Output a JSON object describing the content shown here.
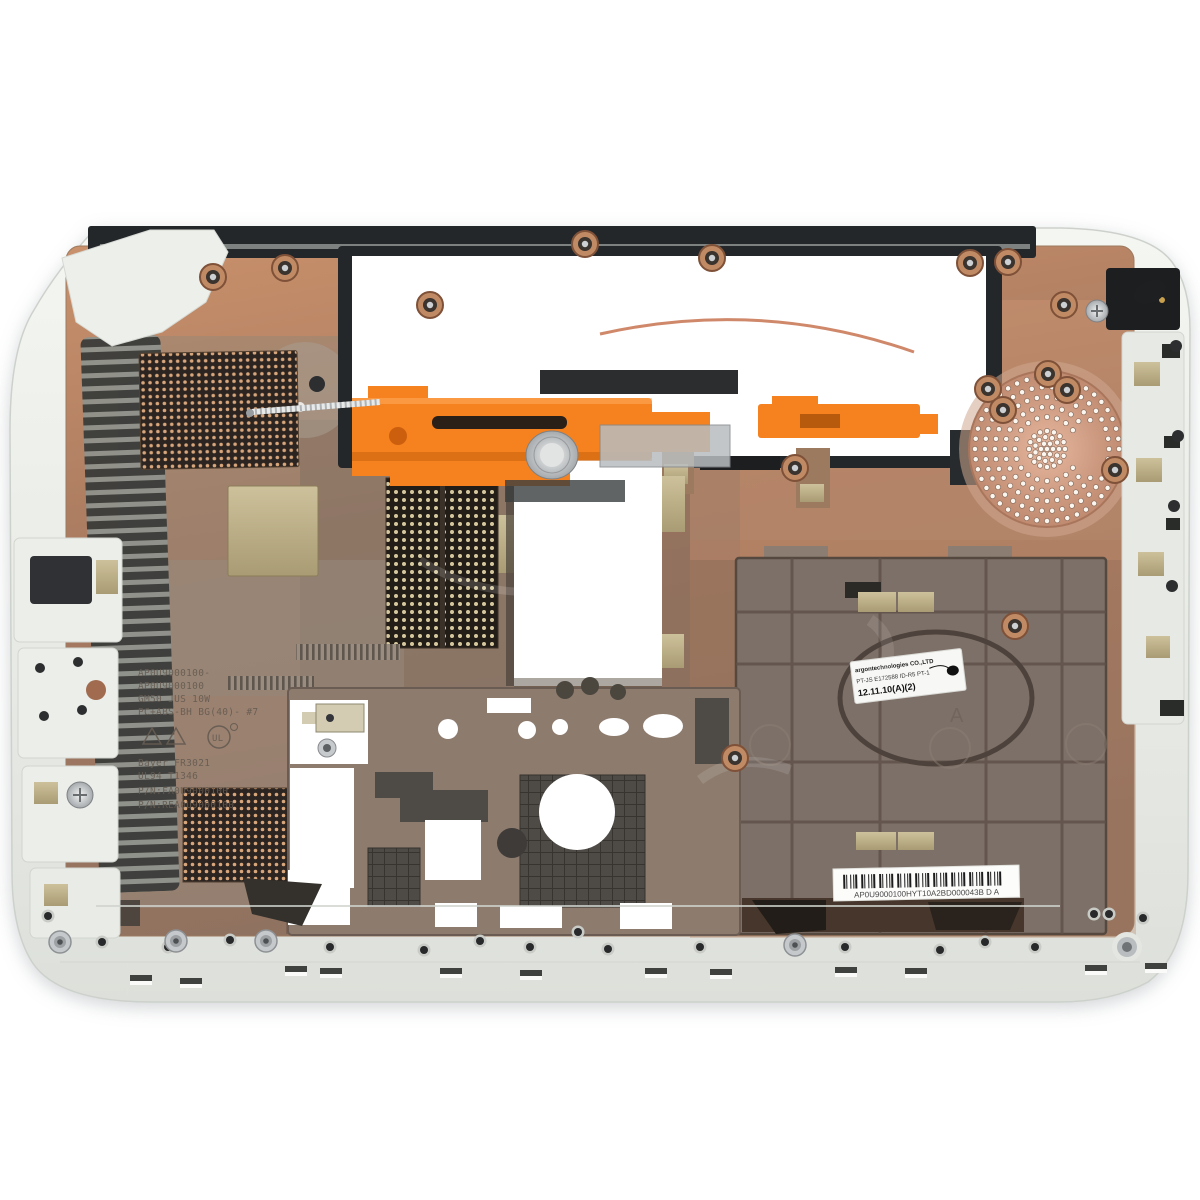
{
  "meta": {
    "title": "Laptop bottom base enclosure — interior view product photo",
    "description": "White plastic laptop bottom case photographed from inside: copper EMI-coated interior, black battery-bay frame, orange optical-drive eject bracket with spring, perforated vent meshes, round speaker grille, molded part numbers, service label and barcode label."
  },
  "palette": {
    "background": "#ffffff",
    "rim": "#e9ebe7",
    "copper": "#c08262",
    "copper_dark": "#8f6f5d",
    "panel_gray": "#7d7068",
    "black_plastic": "#24272a",
    "orange": "#f5821f",
    "khaki_pad": "#bdb188",
    "mesh_dark": "#2b2420",
    "label_white": "#f7f7f5"
  },
  "labels": {
    "info_label": {
      "maker": "argontechnologies CO.,LTD",
      "part": "PT-JS E172588 ID-R5 PT-1",
      "date": "12.11.10(A)(2)"
    },
    "barcode": {
      "text": "AP0U9000100HYT10A2BD000043B  D A"
    },
    "molded": {
      "l1": "AP0U9000100-",
      "l2": "AP0U9000100",
      "l3": "GM50 JUS 10W",
      "l4": "PC+ABS-BH BG(40)- #7",
      "l5": "Bayer FR3021",
      "l6": "UL94 T1346",
      "l7": "P/N:FA0U9000100",
      "l8": "P/N:REA0U9000100",
      "ul_mark": "UL",
      "tray_mark": "A"
    }
  }
}
